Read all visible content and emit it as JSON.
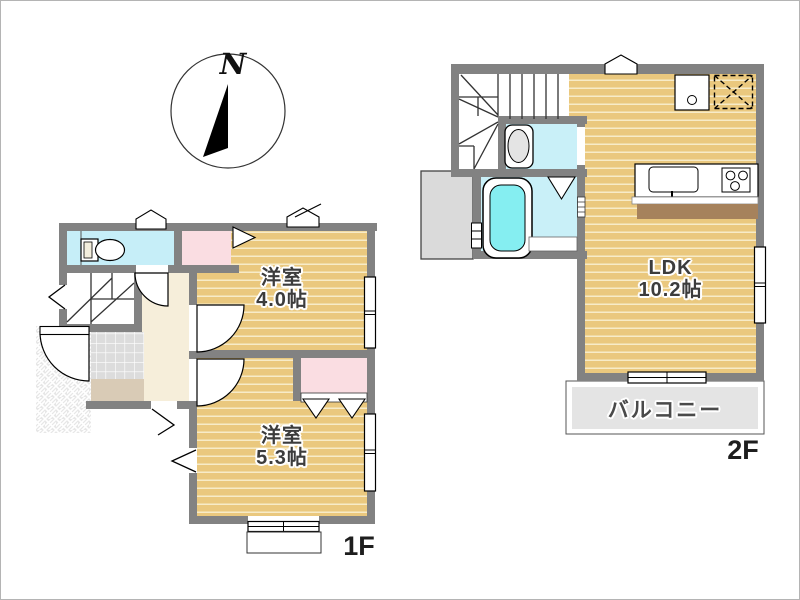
{
  "compass": {
    "label": "N"
  },
  "floor1": {
    "label": "1F",
    "room_a_name": "洋室",
    "room_a_size": "4.0帖",
    "room_b_name": "洋室",
    "room_b_size": "5.3帖"
  },
  "floor2": {
    "label": "2F",
    "ldk_name": "LDK",
    "ldk_size": "10.2帖",
    "balcony": "バルコニー"
  },
  "colors": {
    "wall": "#828282",
    "wood_floor": "#eac87e",
    "wood_stripe": "#f7ebc8",
    "water_room_cyan": "#c9f0f8",
    "closet_pink": "#fadde2",
    "hall_cream": "#f6eeda",
    "entrance_tile": "#dcdcdc",
    "entrance_step": "#d9cbb6",
    "balcony_gray": "#e4e4e4",
    "tub_water": "#85eef1",
    "counter_brown": "#a6825c"
  }
}
